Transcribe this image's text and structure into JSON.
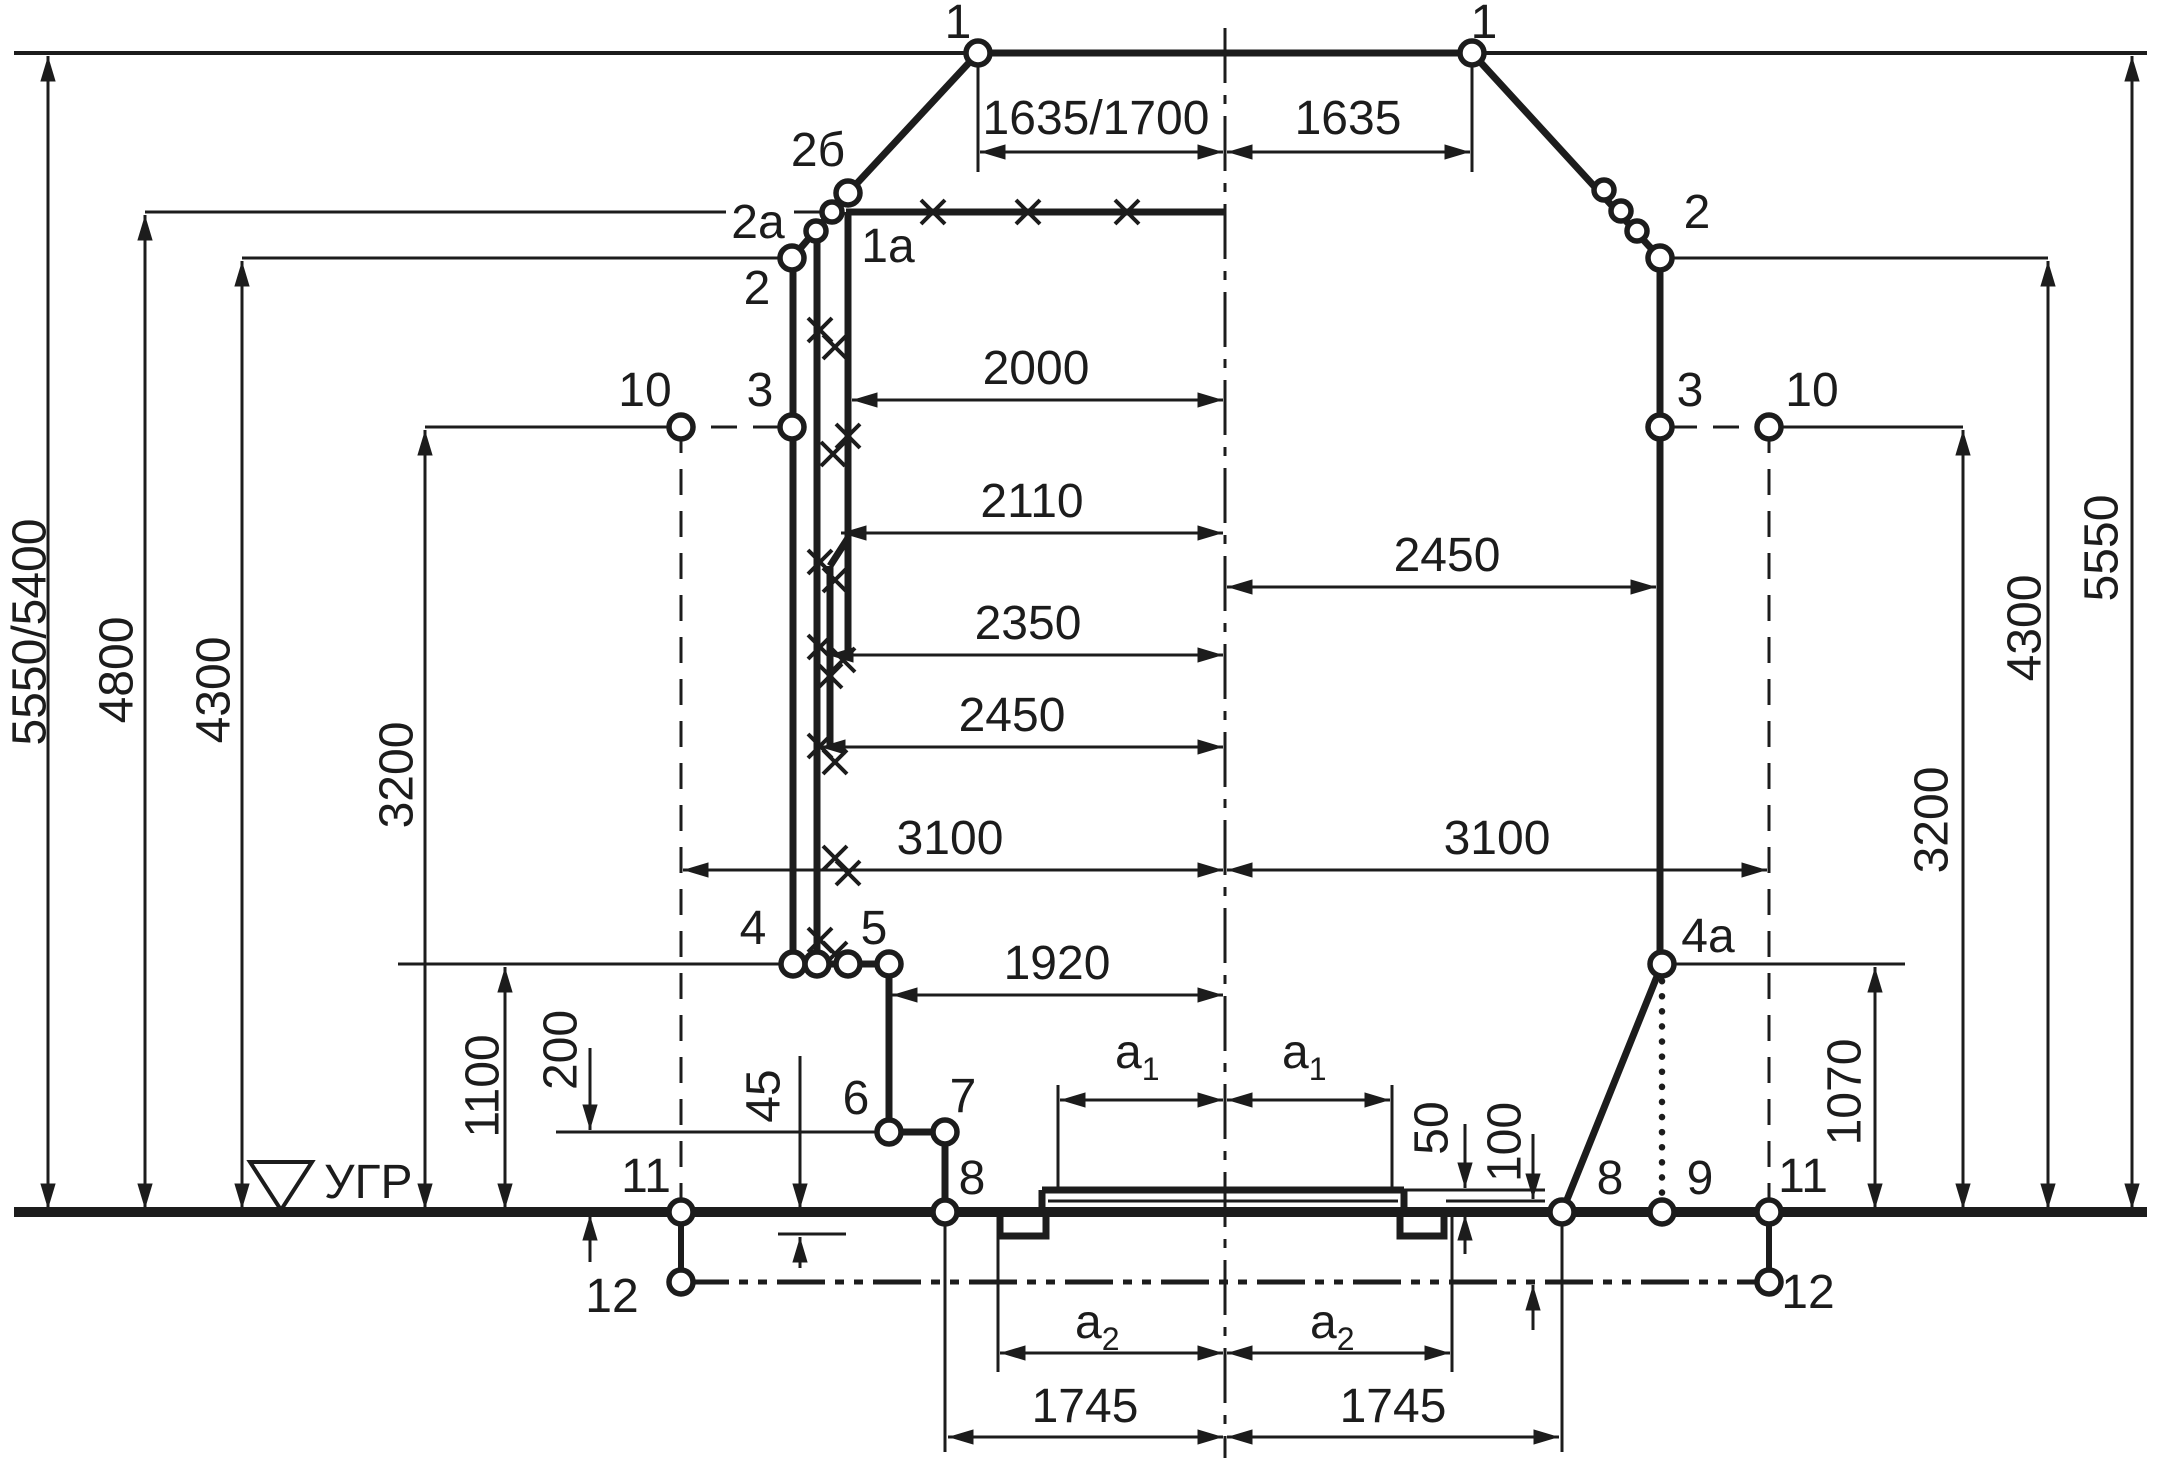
{
  "colors": {
    "ink": "#1c1c1c",
    "background": "#ffffff"
  },
  "points": {
    "p1": "1",
    "p2b": "2б",
    "p2a": "2a",
    "p1a": "1a",
    "p2": "2",
    "p3": "3",
    "p4": "4",
    "p4a": "4a",
    "p5": "5",
    "p6": "6",
    "p7": "7",
    "p8": "8",
    "p9": "9",
    "p10": "10",
    "p11": "11",
    "p12": "12"
  },
  "dims": {
    "top_left": "1635/1700",
    "top_right": "1635",
    "w2000": "2000",
    "w2110": "2110",
    "w2350": "2350",
    "w2450_left": "2450",
    "w2450_right": "2450",
    "w3100_left": "3100",
    "w3100_right": "3100",
    "w1920": "1920",
    "w1745_left": "1745",
    "w1745_right": "1745",
    "a_letter": "a",
    "a1_sub": "1",
    "a2_sub": "2",
    "h5550_5400": "5550/5400",
    "h4800": "4800",
    "h4300_left": "4300",
    "h3200_left": "3200",
    "h1100": "1100",
    "h200": "200",
    "h45": "45",
    "h50": "50",
    "h100": "100",
    "h1070": "1070",
    "h3200_right": "3200",
    "h4300_right": "4300",
    "h5550_right": "5550"
  },
  "rail_level": {
    "label": "УГР"
  }
}
